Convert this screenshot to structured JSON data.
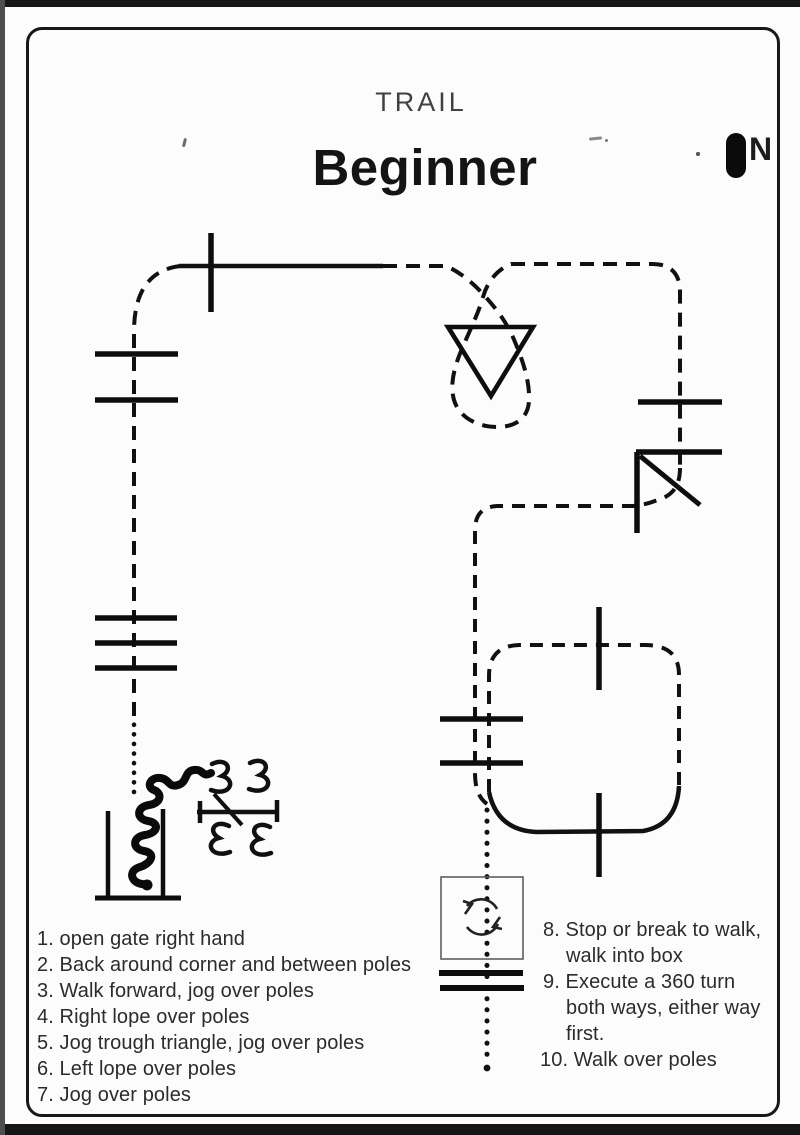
{
  "header": {
    "category": "TRAIL",
    "title": "Beginner"
  },
  "compass": {
    "label": "N"
  },
  "instructions_left": [
    "1. open gate right hand",
    "2. Back around corner and between poles",
    "3. Walk forward, jog over poles",
    "4. Right lope over poles",
    "5. Jog trough triangle, jog over poles",
    "6. Left lope over poles",
    "7. Jog over poles"
  ],
  "instructions_right": [
    "8. Stop or break to walk,",
    "walk into box",
    "9. Execute a 360 turn",
    "both ways, either way",
    "first.",
    "10. Walk over poles"
  ],
  "icons": {
    "north": "filled-pill-marker",
    "turn_360": "circular-arrows",
    "gate": "u-shape-with-squiggle",
    "back_markers": "double-curl-glyphs"
  },
  "colors": {
    "ink": "#111111",
    "paper": "#fcfcfc",
    "title": "#141414",
    "category_text": "#414141",
    "list_text": "#2b2b2b"
  }
}
